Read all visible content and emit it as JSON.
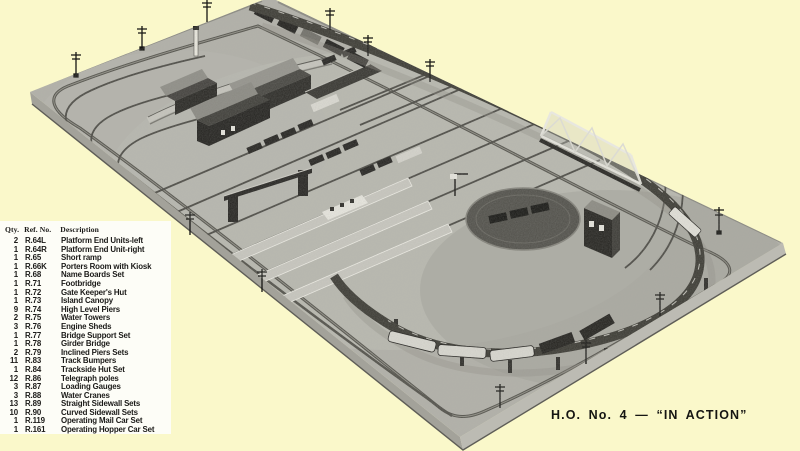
{
  "colors": {
    "page_background": "#faf8ca",
    "panel_background": "#fdfdf7",
    "text": "#1b1a18",
    "photo_board_gray": "#b2b1a9",
    "photo_dark": "#24231f",
    "photo_light": "#e6e5dd"
  },
  "photo": {
    "subject": "aerial black-and-white photograph of an H.O. model railway layout on a rectangular baseboard"
  },
  "caption": {
    "text": "H.O. No. 4 — “IN ACTION”"
  },
  "parts_list": {
    "headers": {
      "qty": "Qty.",
      "ref": "Ref. No.",
      "description": "Description"
    },
    "rows": [
      {
        "qty": "2",
        "ref": "R.64L",
        "description": "Platform End Units-left"
      },
      {
        "qty": "1",
        "ref": "R.64R",
        "description": "Platform End Unit-right"
      },
      {
        "qty": "1",
        "ref": "R.65",
        "description": "Short ramp"
      },
      {
        "qty": "1",
        "ref": "R.66K",
        "description": "Porters Room with Kiosk"
      },
      {
        "qty": "1",
        "ref": "R.68",
        "description": "Name Boards Set"
      },
      {
        "qty": "1",
        "ref": "R.71",
        "description": "Footbridge"
      },
      {
        "qty": "1",
        "ref": "R.72",
        "description": "Gate Keeper's Hut"
      },
      {
        "qty": "1",
        "ref": "R.73",
        "description": "Island Canopy"
      },
      {
        "qty": "9",
        "ref": "R.74",
        "description": "High Level Piers"
      },
      {
        "qty": "2",
        "ref": "R.75",
        "description": "Water Towers"
      },
      {
        "qty": "3",
        "ref": "R.76",
        "description": "Engine Sheds"
      },
      {
        "qty": "1",
        "ref": "R.77",
        "description": "Bridge Support Set"
      },
      {
        "qty": "1",
        "ref": "R.78",
        "description": "Girder Bridge"
      },
      {
        "qty": "2",
        "ref": "R.79",
        "description": "Inclined Piers Sets"
      },
      {
        "qty": "11",
        "ref": "R.83",
        "description": "Track Bumpers"
      },
      {
        "qty": "1",
        "ref": "R.84",
        "description": "Trackside Hut Set"
      },
      {
        "qty": "12",
        "ref": "R.86",
        "description": "Telegraph poles"
      },
      {
        "qty": "3",
        "ref": "R.87",
        "description": "Loading Gauges"
      },
      {
        "qty": "3",
        "ref": "R.88",
        "description": "Water Cranes"
      },
      {
        "qty": "13",
        "ref": "R.89",
        "description": "Straight Sidewall Sets"
      },
      {
        "qty": "10",
        "ref": "R.90",
        "description": "Curved Sidewall Sets"
      },
      {
        "qty": "1",
        "ref": "R.119",
        "description": "Operating Mail Car Set"
      },
      {
        "qty": "1",
        "ref": "R.161",
        "description": "Operating Hopper Car Set"
      }
    ]
  }
}
